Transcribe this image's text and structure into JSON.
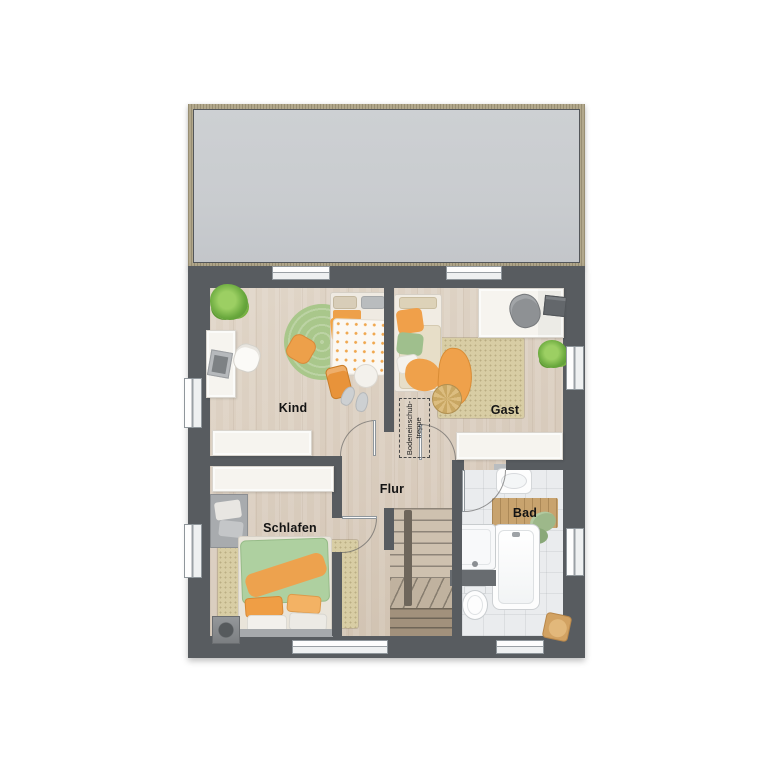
{
  "palette": {
    "wall": "#585c60",
    "floor-wood": "#d8cbbc",
    "floor-tile": "#eaecee",
    "roof-fill": "#c9cccf",
    "roof-trim": "#b2a88c",
    "furniture-white": "#f6f4ef",
    "rug-green": "#a9c78b",
    "rug-beige": "#d8cda4",
    "textile-orange": "#eda04a",
    "textile-green": "#aed0a0",
    "stair-wood": "#cec1af",
    "label-color": "#141414"
  },
  "floorplan": {
    "rooms": [
      {
        "id": "kind",
        "label": "Kind",
        "furniture": [
          "bed",
          "desk",
          "desk-chair",
          "round-rug",
          "plant",
          "wardrobe",
          "floor-pillow",
          "pouf",
          "slippers",
          "school-bag"
        ]
      },
      {
        "id": "gast",
        "label": "Gast",
        "furniture": [
          "bed",
          "rug",
          "throw-blanket",
          "woven-pouf",
          "desk",
          "desk-chair",
          "printer",
          "plant",
          "wardrobe"
        ]
      },
      {
        "id": "flur",
        "label": "Flur",
        "furniture": [
          "staircase"
        ]
      },
      {
        "id": "schlafen",
        "label": "Schlafen",
        "furniture": [
          "double-bed",
          "rug",
          "wardrobe",
          "dresser",
          "speaker"
        ]
      },
      {
        "id": "bad",
        "label": "Bad",
        "furniture": [
          "washbasin",
          "bath-mat",
          "towels",
          "bathtub",
          "shower",
          "vanity-counter",
          "toilet",
          "stool"
        ]
      }
    ],
    "annotations": {
      "attic_hatch": {
        "line1": "Bodeneinschub-",
        "line2": "treppe"
      }
    }
  }
}
